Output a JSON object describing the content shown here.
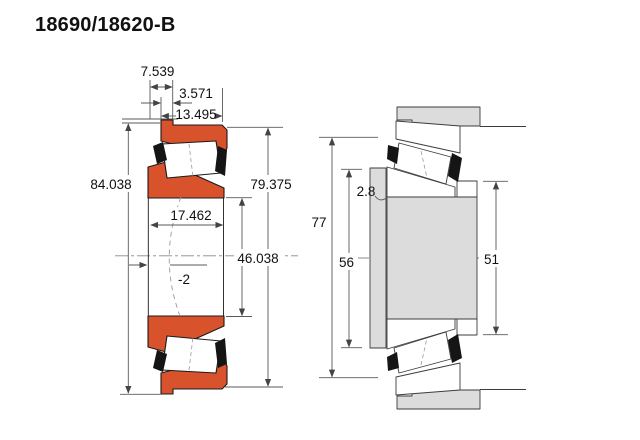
{
  "title": "18690/18620-B",
  "colors": {
    "ring_orange": "#d8522c",
    "metal_grey": "#dcdcdc",
    "cage_black": "#151515",
    "dim_line": "#5a5a5a"
  },
  "left_view": {
    "description": "bearing cross-section",
    "dims": {
      "cone_protrusion": "7.539",
      "flange_width": "3.571",
      "cup_width": "13.495",
      "flange_od": "84.038",
      "cup_od": "79.375",
      "overall_width": "17.462",
      "bore": "46.038",
      "load_center": "-2"
    }
  },
  "right_view": {
    "description": "shaft and housing mounting diagram",
    "dims": {
      "housing_shoulder": "77",
      "shaft_shoulder": "56",
      "spacer_shoulder": "51",
      "fillet_radius": "2.8"
    }
  }
}
